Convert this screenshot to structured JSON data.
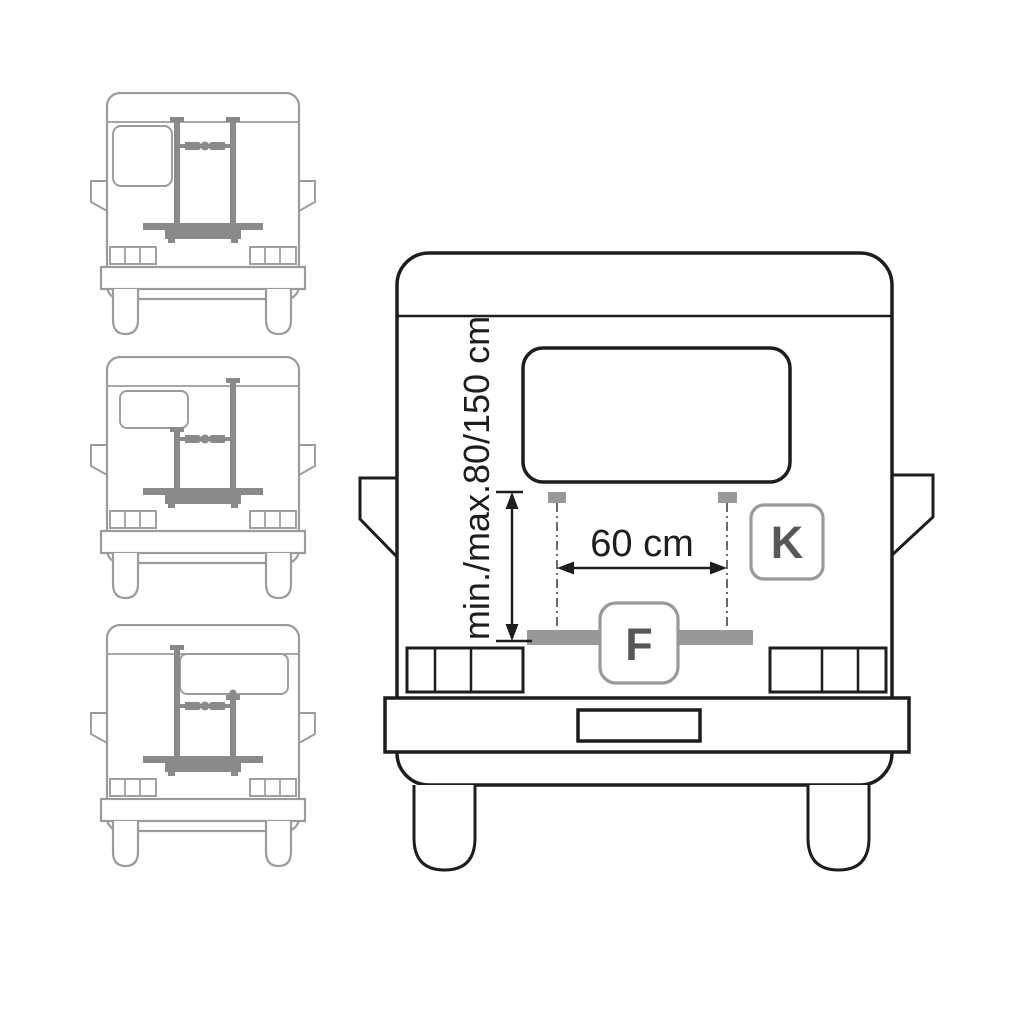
{
  "colors": {
    "ink": "#1d1d1b",
    "thumbnail_outline_gray": "#9b9b9b",
    "rack_gray": "#8a8a8a",
    "accessory_gray": "#999999",
    "badge_letter_gray": "#575756",
    "background": "#ffffff"
  },
  "main_diagram": {
    "vertical_dimension_label": "min./max.80/150 cm",
    "width_dimension_label": "60 cm",
    "badge_k": "K",
    "badge_f": "F"
  },
  "thumbnails": [
    {
      "id": "van-rear-rack-config-1"
    },
    {
      "id": "van-rear-rack-config-2"
    },
    {
      "id": "van-rear-rack-config-3"
    }
  ]
}
